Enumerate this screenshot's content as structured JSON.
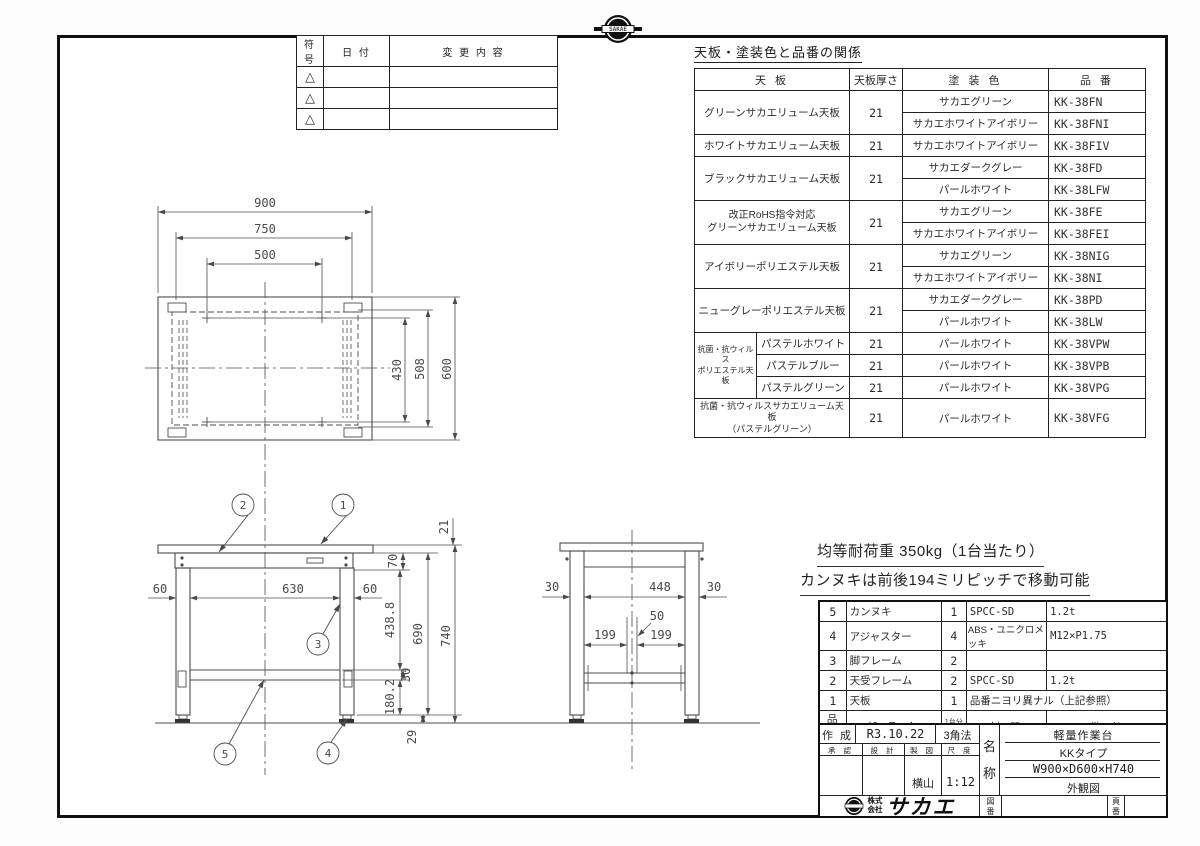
{
  "logo": {
    "brand": "SAKAE",
    "company_prefix": "株式\n会社",
    "company_name": "サカエ"
  },
  "revision_table": {
    "headers": {
      "symbol": "符号",
      "date": "日 付",
      "content": "変 更 内 容"
    },
    "row_symbol": "△"
  },
  "spec_table": {
    "title": "天板・塗装色と品番の関係",
    "headers": {
      "tenban": "天 板",
      "thickness": "天板厚さ",
      "color": "塗 装 色",
      "code": "品 番"
    },
    "rows": [
      {
        "tenban": "グリーンサカエリューム天板",
        "thk": "21",
        "color": "サカエグリーン",
        "code": "KK-38FN"
      },
      {
        "color": "サカエホワイトアイボリー",
        "code": "KK-38FNI"
      },
      {
        "tenban": "ホワイトサカエリューム天板",
        "thk": "21",
        "color": "サカエホワイトアイボリー",
        "code": "KK-38FIV"
      },
      {
        "tenban": "ブラックサカエリューム天板",
        "thk": "21",
        "color": "サカエダークグレー",
        "code": "KK-38FD"
      },
      {
        "color": "パールホワイト",
        "code": "KK-38LFW"
      },
      {
        "tenban": "改正RoHS指令対応\nグリーンサカエリューム天板",
        "thk": "21",
        "color": "サカエグリーン",
        "code": "KK-38FE"
      },
      {
        "color": "サカエホワイトアイボリー",
        "code": "KK-38FEI"
      },
      {
        "tenban": "アイボリーポリエステル天板",
        "thk": "21",
        "color": "サカエグリーン",
        "code": "KK-38NIG"
      },
      {
        "color": "サカエホワイトアイボリー",
        "code": "KK-38NI"
      },
      {
        "tenban": "ニューグレーポリエステル天板",
        "thk": "21",
        "color": "サカエダークグレー",
        "code": "KK-38PD"
      },
      {
        "color": "パールホワイト",
        "code": "KK-38LW"
      },
      {
        "group": "抗菌・抗ウィルス\nポリエステル天板",
        "sub": "パステルホワイト",
        "thk": "21",
        "color": "パールホワイト",
        "code": "KK-38VPW"
      },
      {
        "sub": "パステルブルー",
        "thk": "21",
        "color": "パールホワイト",
        "code": "KK-38VPB"
      },
      {
        "sub": "パステルグリーン",
        "thk": "21",
        "color": "パールホワイト",
        "code": "KK-38VPG"
      },
      {
        "tenban": "抗菌・抗ウィルスサカエリューム天板\n（パステルグリーン）",
        "thk": "21",
        "color": "パールホワイト",
        "code": "KK-38VFG"
      }
    ]
  },
  "drawing": {
    "top_view": {
      "dim_900": "900",
      "dim_750": "750",
      "dim_500": "500",
      "dim_430": "430",
      "dim_508": "508",
      "dim_600": "600"
    },
    "front_view": {
      "dim_21": "21",
      "dim_70": "70",
      "dim_60L": "60",
      "dim_630": "630",
      "dim_60R": "60",
      "dim_438": "438.8",
      "dim_690": "690",
      "dim_740": "740",
      "dim_30": "30",
      "dim_180": "180.2",
      "dim_29": "29",
      "balloons": {
        "b1": "1",
        "b2": "2",
        "b3": "3",
        "b4": "4",
        "b5": "5"
      }
    },
    "side_view": {
      "dim_30L": "30",
      "dim_448": "448",
      "dim_30R": "30",
      "dim_50": "50",
      "dim_199L": "199",
      "dim_199R": "199"
    }
  },
  "notes": {
    "line1": "均等耐荷重 350kg（1台当たり）",
    "line2": "カンヌキは前後194ミリピッチで移動可能"
  },
  "parts_table": {
    "headers": {
      "no": "品 番",
      "name": "部 品 名",
      "qty": "1台分\n数量",
      "material": "材 質",
      "remarks": "備 考"
    },
    "rows": [
      {
        "no": "5",
        "name": "カンヌキ",
        "qty": "1",
        "material": "SPCC-SD",
        "remarks": "1.2t"
      },
      {
        "no": "4",
        "name": "アジャスター",
        "qty": "4",
        "material": "ABS・ユニクロメッキ",
        "remarks": "M12×P1.75"
      },
      {
        "no": "3",
        "name": "脚フレーム",
        "qty": "2",
        "material": "",
        "remarks": ""
      },
      {
        "no": "2",
        "name": "天受フレーム",
        "qty": "2",
        "material": "SPCC-SD",
        "remarks": "1.2t"
      },
      {
        "no": "1",
        "name": "天板",
        "qty": "1",
        "material": "品番ニヨリ異ナル（上記参照）"
      }
    ]
  },
  "title_block": {
    "created_label": "作 成",
    "created_date": "R3.10.22",
    "projection": "3角法",
    "approve_label": "承 認",
    "design_label": "設 計",
    "draft_label": "製 図",
    "scale_label": "尺 度",
    "drafter": "横山",
    "scale": "1:12",
    "name_label": "名\n称",
    "product_name": "軽量作業台",
    "product_type": "KKタイプ",
    "product_size": "W900×D600×H740",
    "drawing_type": "外観図",
    "drawing_no_label": "図\n番",
    "page_no_label": "頁\n番"
  }
}
